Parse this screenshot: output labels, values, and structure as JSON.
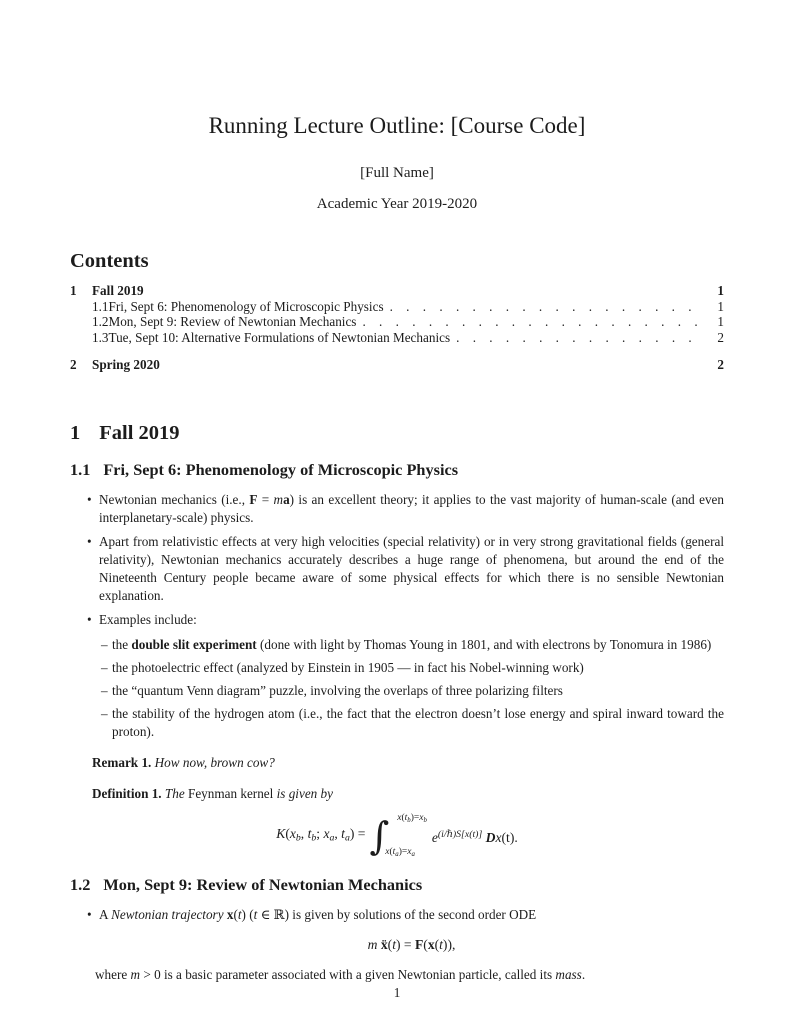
{
  "accent_color": "#1c1c1c",
  "background_color": "#ffffff",
  "title_block": {
    "title": "Running Lecture Outline: [Course Code]",
    "author": "[Full Name]",
    "date": "Academic Year 2019-2020"
  },
  "contents": {
    "heading": "Contents",
    "entries": [
      {
        "num": "1",
        "label": "Fall 2019",
        "page": "1",
        "level": 1
      },
      {
        "num": "1.1",
        "label": "Fri, Sept 6: Phenomenology of Microscopic Physics",
        "page": "1",
        "level": 2
      },
      {
        "num": "1.2",
        "label": "Mon, Sept 9: Review of Newtonian Mechanics",
        "page": "1",
        "level": 2
      },
      {
        "num": "1.3",
        "label": "Tue, Sept 10: Alternative Formulations of Newtonian Mechanics",
        "page": "2",
        "level": 2
      },
      {
        "num": "2",
        "label": "Spring 2020",
        "page": "2",
        "level": 1
      }
    ]
  },
  "section1": {
    "num": "1",
    "title": "Fall 2019"
  },
  "subsection11": {
    "num": "1.1",
    "title": "Fri, Sept 6: Phenomenology of Microscopic Physics"
  },
  "body11": {
    "bullet1": [
      {
        "t": "Newtonian mechanics (i.e., "
      },
      {
        "t": "F",
        "s": "b"
      },
      {
        "t": " = "
      },
      {
        "t": "m",
        "s": "i"
      },
      {
        "t": "a",
        "s": "b"
      },
      {
        "t": ") is an excellent theory; it applies to the vast majority of human-scale (and even interplanetary-scale) physics."
      }
    ],
    "bullet2": [
      {
        "t": "Apart from relativistic effects at very high velocities (special relativity) or in very strong gravitational fields (general relativity), Newtonian mechanics accurately describes a huge range of phenomena, but around the end of the Nineteenth Century people became aware of some physical effects for which there is no sensible Newtonian explanation."
      }
    ],
    "bullet3": [
      {
        "t": "Examples include:"
      }
    ],
    "subitems": [
      [
        {
          "t": "the "
        },
        {
          "t": "double slit experiment",
          "s": "b"
        },
        {
          "t": " (done with light by Thomas Young in 1801, and with electrons by Tonomura in 1986)"
        }
      ],
      [
        {
          "t": "the photoelectric effect (analyzed by Einstein in 1905 — in fact his Nobel-winning work)"
        }
      ],
      [
        {
          "t": "the “quantum Venn diagram” puzzle, involving the overlaps of three polarizing filters"
        }
      ],
      [
        {
          "t": "the stability of the hydrogen atom (i.e., the fact that the electron doesn’t lose energy and spiral inward toward the proton)."
        }
      ]
    ],
    "remark": [
      {
        "t": "Remark 1.",
        "s": "b"
      },
      {
        "t": " How now, brown cow?",
        "s": "i"
      }
    ],
    "definition": [
      {
        "t": "Definition 1.",
        "s": "b"
      },
      {
        "t": " The ",
        "s": "i"
      },
      {
        "t": "Feynman kernel"
      },
      {
        "t": " is given by",
        "s": "i"
      }
    ]
  },
  "math": {
    "kernel": {
      "lhs": [
        {
          "t": "K",
          "s": "i"
        },
        {
          "t": "("
        },
        {
          "t": "x",
          "s": "i"
        },
        {
          "t": "b",
          "s": "isub"
        },
        {
          "t": ", "
        },
        {
          "t": "t",
          "s": "i"
        },
        {
          "t": "b",
          "s": "isub"
        },
        {
          "t": "; "
        },
        {
          "t": "x",
          "s": "i"
        },
        {
          "t": "a",
          "s": "isub"
        },
        {
          "t": ", "
        },
        {
          "t": "t",
          "s": "i"
        },
        {
          "t": "a",
          "s": "isub"
        },
        {
          "t": ") = "
        }
      ],
      "integral_sign": "∫",
      "upper": [
        {
          "t": "x",
          "s": "i"
        },
        {
          "t": "("
        },
        {
          "t": "t",
          "s": "i"
        },
        {
          "t": "b",
          "s": "isub"
        },
        {
          "t": ")="
        },
        {
          "t": "x",
          "s": "i"
        },
        {
          "t": "b",
          "s": "isub"
        }
      ],
      "lower": [
        {
          "t": "x",
          "s": "i"
        },
        {
          "t": "("
        },
        {
          "t": "t",
          "s": "i"
        },
        {
          "t": "a",
          "s": "isub"
        },
        {
          "t": ")="
        },
        {
          "t": "x",
          "s": "i"
        },
        {
          "t": "a",
          "s": "isub"
        }
      ],
      "rhs": [
        {
          "t": "e",
          "s": "i"
        },
        {
          "t": "(i/ℏ)S[x(t)]",
          "s": "isup"
        },
        {
          "t": " "
        },
        {
          "t": "D",
          "s": "scr"
        },
        {
          "t": "x",
          "s": "i"
        },
        {
          "t": "(t)."
        }
      ]
    },
    "ode": [
      {
        "t": "m",
        "s": "i"
      },
      {
        "t": " "
      },
      {
        "t": "ẍ",
        "s": "b"
      },
      {
        "t": "("
      },
      {
        "t": "t",
        "s": "i"
      },
      {
        "t": ") = "
      },
      {
        "t": "F",
        "s": "b"
      },
      {
        "t": "("
      },
      {
        "t": "x",
        "s": "b"
      },
      {
        "t": "("
      },
      {
        "t": "t",
        "s": "i"
      },
      {
        "t": ")),"
      }
    ]
  },
  "subsection12": {
    "num": "1.2",
    "title": "Mon, Sept 9: Review of Newtonian Mechanics"
  },
  "body12": {
    "bullet1": [
      {
        "t": "A "
      },
      {
        "t": "Newtonian trajectory ",
        "s": "i"
      },
      {
        "t": "x",
        "s": "b"
      },
      {
        "t": "("
      },
      {
        "t": "t",
        "s": "i"
      },
      {
        "t": ") ("
      },
      {
        "t": "t",
        "s": "i"
      },
      {
        "t": " ∈ ℝ) is given by solutions of the second order ODE"
      }
    ],
    "where": [
      {
        "t": "where "
      },
      {
        "t": "m ",
        "s": "i"
      },
      {
        "t": "> 0 is a basic parameter associated with a given Newtonian particle, called its "
      },
      {
        "t": "mass",
        "s": "i"
      },
      {
        "t": "."
      }
    ]
  },
  "footer": {
    "page_number": "1"
  }
}
